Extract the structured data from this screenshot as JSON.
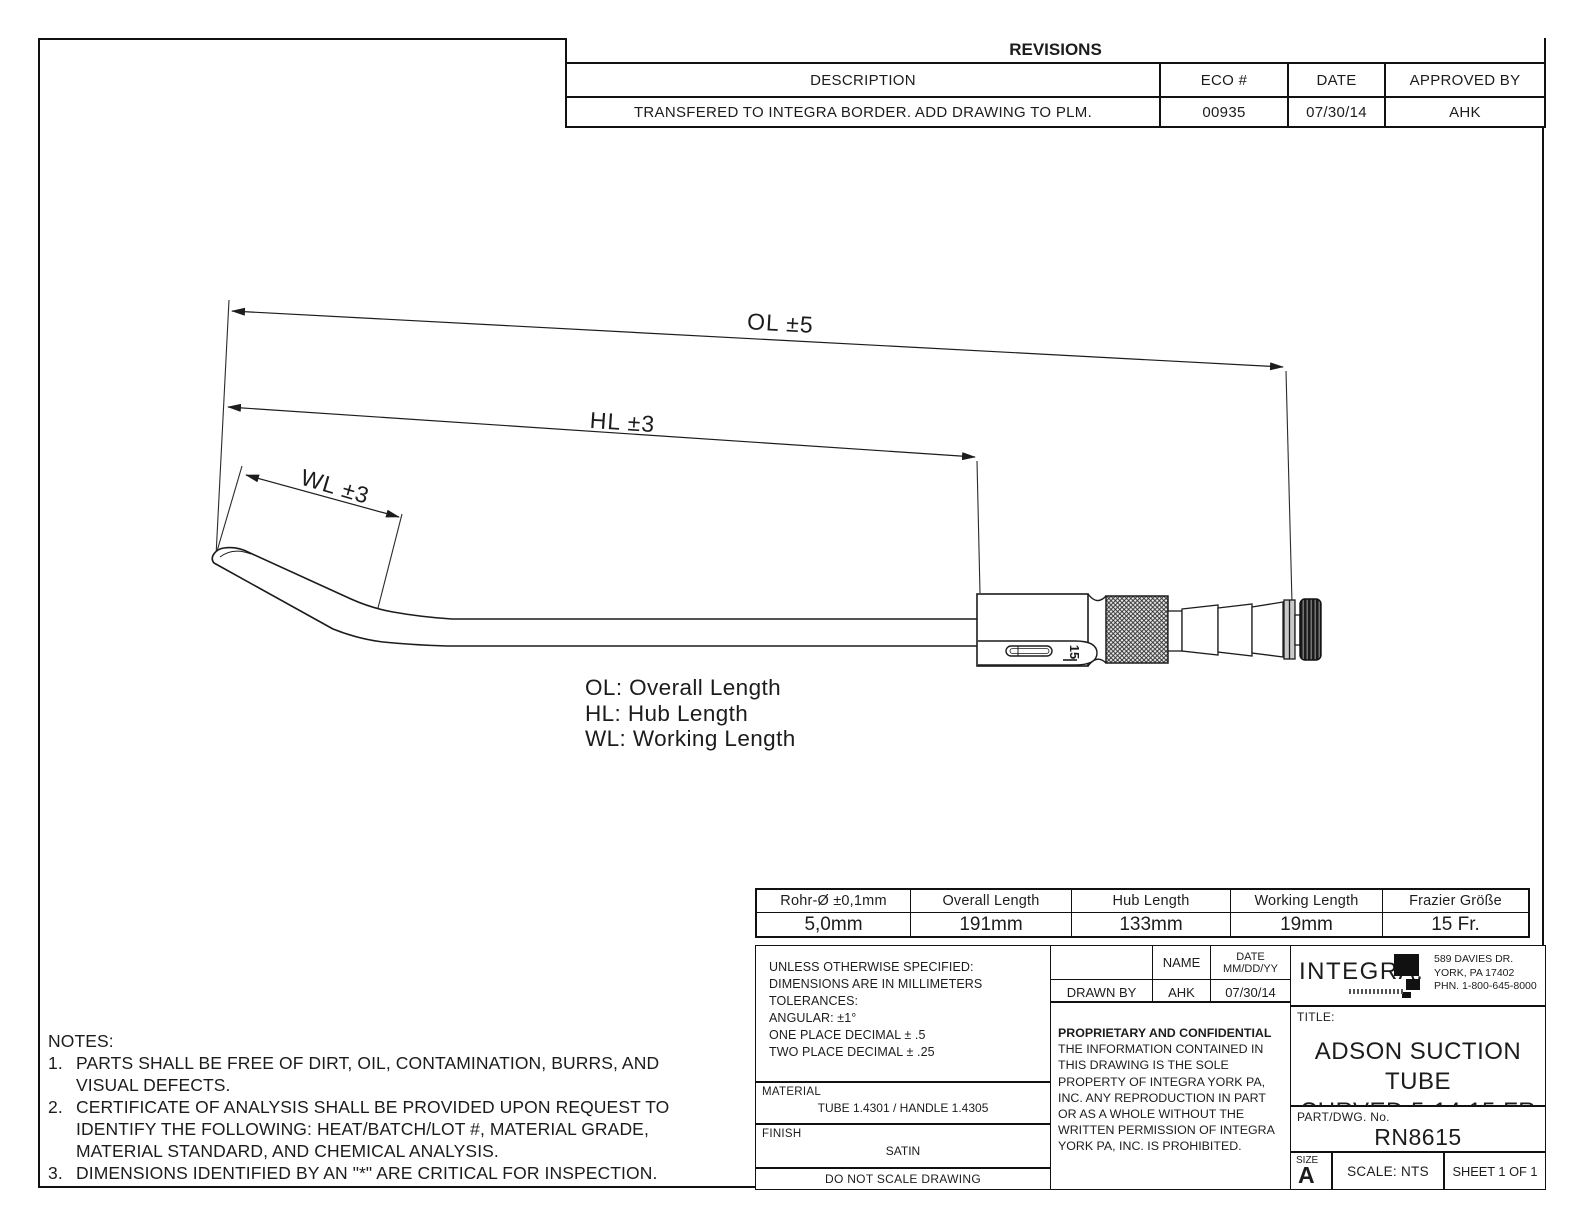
{
  "colors": {
    "ink": "#1c1c1c",
    "paper": "#ffffff"
  },
  "revisions": {
    "title": "REVISIONS",
    "headers": [
      "DESCRIPTION",
      "ECO #",
      "DATE",
      "APPROVED BY"
    ],
    "rows": [
      [
        "TRANSFERED TO INTEGRA BORDER. ADD DRAWING TO PLM.",
        "00935",
        "07/30/14",
        "AHK"
      ]
    ]
  },
  "drawing": {
    "dim_ol": "OL ±5",
    "dim_hl": "HL ±3",
    "dim_wl": "WL ±3",
    "hub_marking": "15",
    "legend": [
      "OL: Overall Length",
      "HL: Hub Length",
      "WL: Working Length"
    ]
  },
  "dim_table": {
    "headers": [
      "Rohr-Ø ±0,1mm",
      "Overall Length",
      "Hub Length",
      "Working Length",
      "Frazier Größe"
    ],
    "values": [
      "5,0mm",
      "191mm",
      "133mm",
      "19mm",
      "15 Fr."
    ]
  },
  "tolerances": {
    "lines": [
      "UNLESS OTHERWISE SPECIFIED:",
      "DIMENSIONS ARE IN MILLIMETERS",
      "TOLERANCES:",
      "ANGULAR: ±1°",
      "ONE PLACE DECIMAL ± .5",
      "TWO PLACE DECIMAL ± .25"
    ]
  },
  "material": {
    "label": "MATERIAL",
    "value": "TUBE 1.4301 / HANDLE 1.4305"
  },
  "finish": {
    "label": "FINISH",
    "value": "SATIN"
  },
  "do_not_scale": "DO NOT SCALE DRAWING",
  "sign_table": {
    "name_header": "NAME",
    "date_header_line1": "DATE",
    "date_header_line2": "MM/DD/YY",
    "drawn_by_label": "DRAWN BY",
    "drawn_by_name": "AHK",
    "drawn_by_date": "07/30/14"
  },
  "proprietary": {
    "title": "PROPRIETARY AND CONFIDENTIAL",
    "body": "THE INFORMATION CONTAINED IN THIS DRAWING IS THE SOLE PROPERTY OF INTEGRA YORK PA, INC.  ANY REPRODUCTION IN PART OR AS A WHOLE WITHOUT THE WRITTEN PERMISSION OF INTEGRA YORK PA, INC. IS PROHIBITED."
  },
  "company": {
    "logo_text": "INTEGRA.",
    "address": [
      "589 DAVIES DR.",
      "YORK, PA 17402",
      "PHN. 1-800-645-8000"
    ]
  },
  "title_block": {
    "title_label": "TITLE:",
    "title_line1": "ADSON SUCTION TUBE",
    "title_line2": "CURVED 5-14 15 FR",
    "part_label": "PART/DWG. No.",
    "part_number": "RN8615",
    "size_label": "SIZE",
    "size_value": "A",
    "scale": "SCALE: NTS",
    "sheet": "SHEET 1 OF 1"
  },
  "notes": {
    "label": "NOTES:",
    "items": [
      {
        "num": "1.",
        "lines": [
          "PARTS SHALL BE FREE OF DIRT, OIL, CONTAMINATION, BURRS, AND",
          "VISUAL DEFECTS."
        ]
      },
      {
        "num": "2.",
        "lines": [
          "CERTIFICATE OF ANALYSIS SHALL BE PROVIDED UPON REQUEST TO",
          "IDENTIFY THE FOLLOWING: HEAT/BATCH/LOT #, MATERIAL GRADE,",
          "MATERIAL STANDARD, AND CHEMICAL ANALYSIS."
        ]
      },
      {
        "num": "3.",
        "lines": [
          "DIMENSIONS IDENTIFIED BY AN \"*\" ARE CRITICAL FOR INSPECTION."
        ]
      }
    ]
  }
}
